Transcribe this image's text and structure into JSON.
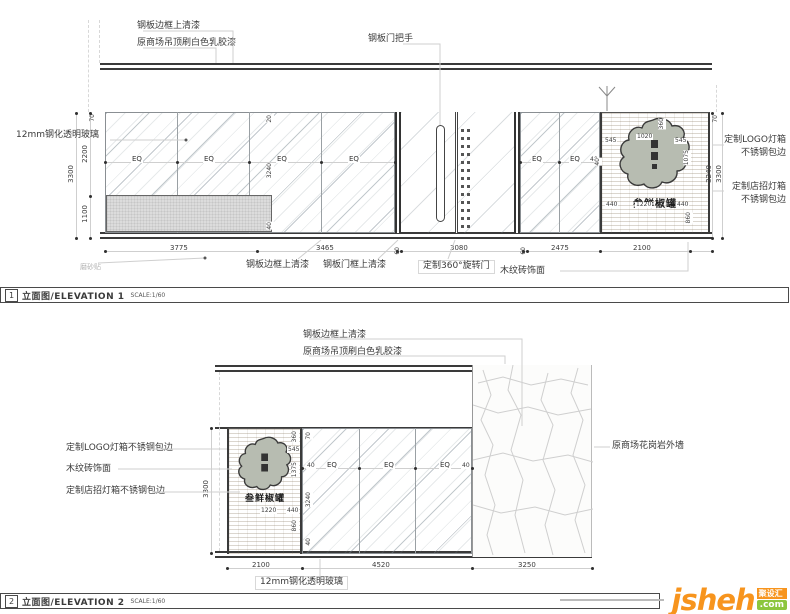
{
  "eq_label": "EQ",
  "elevation1": {
    "index": "1",
    "title": "立面图/ELEVATION 1",
    "scale": "SCALE:1/60",
    "annotations": {
      "frame_varnish_top": "钢板边框上清漆",
      "ceiling_paint": "原商场吊顶刷白色乳胶漆",
      "door_handle": "钢板门把手",
      "glass_left": "12mm钢化透明玻璃",
      "logo_lightbox_line1": "定制LOGO灯箱",
      "logo_lightbox_line2": "不锈钢包边",
      "sign_lightbox_line1": "定制店招灯箱",
      "sign_lightbox_line2": "不锈钢包边",
      "frosted_film": "磨砂贴",
      "frame_varnish_bottom": "钢板边框上清漆",
      "door_frame_varnish": "钢板门框上清漆",
      "revolving_door": "定制360°旋转门",
      "wood_tile": "木纹砖饰面"
    },
    "dims": {
      "left_top": "70",
      "left_upper": "2200",
      "left_lower": "1100",
      "left_total": "3300",
      "mid_top": "20",
      "mid_glass": "3240",
      "mid_base": "40",
      "right_top": "70",
      "right_inner": "3240",
      "right_total": "3300",
      "glass_b_40": "40",
      "bottom": [
        "3775",
        "3465",
        "60",
        "3080",
        "60",
        "2475",
        "2100"
      ],
      "logo_top": "360",
      "logo_left": "545",
      "logo_mid": "1020",
      "logo_right": "545",
      "logo_h": "1075",
      "logo_b_left": "440",
      "logo_b_mid": "1220",
      "logo_b_right": "440",
      "logo_b_h": "860",
      "logo_40": "40"
    },
    "logo_text": "叁鲜椒罐"
  },
  "elevation2": {
    "index": "2",
    "title": "立面图/ELEVATION 2",
    "scale": "SCALE:1/60",
    "annotations": {
      "frame_varnish_top": "钢板边框上清漆",
      "ceiling_paint": "原商场吊顶刷白色乳胶漆",
      "logo_lightbox": "定制LOGO灯箱不锈钢包边",
      "wood_tile": "木纹砖饰面",
      "sign_lightbox": "定制店招灯箱不锈钢包边",
      "granite_wall": "原商场花岗岩外墙",
      "glass_bottom": "12mm钢化透明玻璃"
    },
    "dims": {
      "left_total": "3300",
      "glass_top": "70",
      "glass_h": "3240",
      "glass_base": "40",
      "eq_40_left": "40",
      "eq_40_right": "40",
      "logo_top": "360",
      "logo_545": "545",
      "logo_1375": "1375",
      "logo_860": "860",
      "logo_b_mid": "1220",
      "logo_b_right": "440",
      "bottom": [
        "2100",
        "4520",
        "3250"
      ]
    },
    "logo_text": "叁鲜椒罐"
  },
  "watermark": {
    "brand": "jsheh",
    "cn_badge": "聚设汇",
    "com_badge": ".com"
  }
}
